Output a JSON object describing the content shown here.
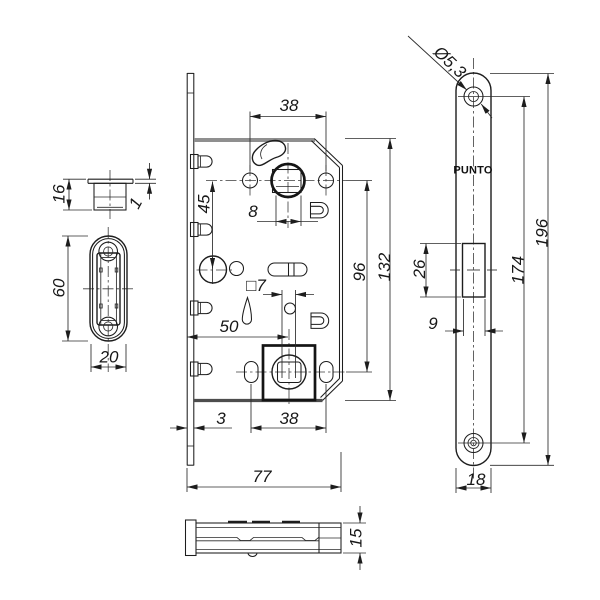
{
  "brand": "PUNTO",
  "views": {
    "latch_top": {
      "height": "16",
      "flange_thickness": "1"
    },
    "strike_plate": {
      "height": "60",
      "width": "20"
    },
    "lock_body": {
      "top_hole_spacing": "38",
      "spindle_square": "8",
      "magnet_offset": "45",
      "follower_distance": "96",
      "case_height": "132",
      "backset": "50",
      "wc_square": "□7",
      "faceplate_thickness": "3",
      "bottom_hole_spacing": "38",
      "case_depth": "77"
    },
    "faceplate": {
      "screw_hole_dia": "Ø5,3",
      "plate_length": "196",
      "screw_hole_distance": "174",
      "cutout_height": "26",
      "cutout_width": "9",
      "plate_width": "18"
    },
    "bottom_view": {
      "case_thickness": "15"
    }
  }
}
